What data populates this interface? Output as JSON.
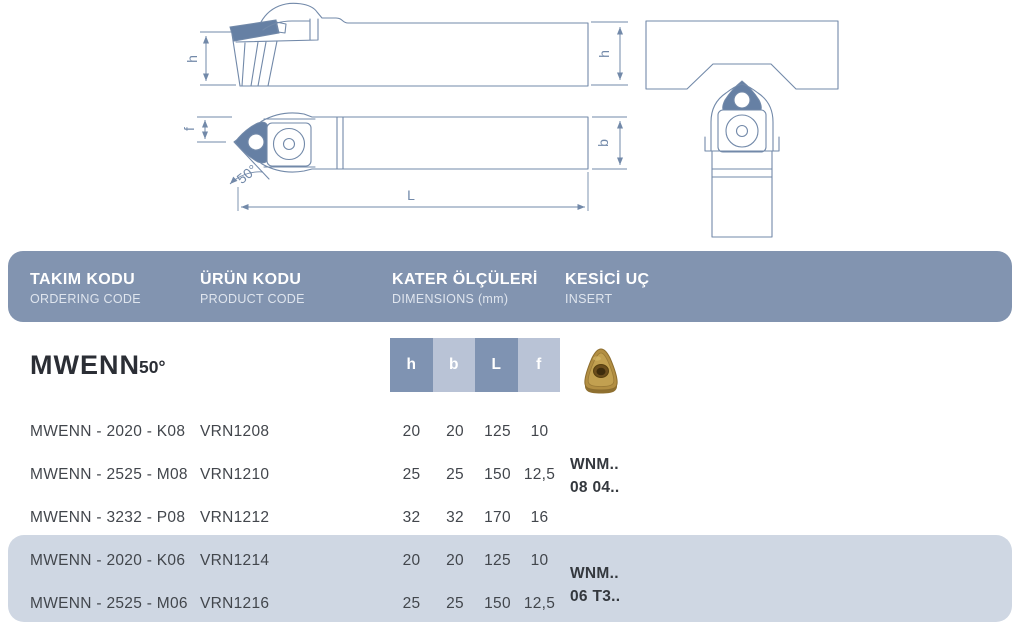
{
  "header": {
    "columns": [
      {
        "title": "TAKIM KODU",
        "subtitle": "ORDERING CODE"
      },
      {
        "title": "ÜRÜN KODU",
        "subtitle": "PRODUCT CODE"
      },
      {
        "title": "KATER ÖLÇÜLERİ",
        "subtitle": "DIMENSIONS (mm)"
      },
      {
        "title": "KESİCİ UÇ",
        "subtitle": "INSERT"
      }
    ]
  },
  "series": {
    "name": "MWENN",
    "approach_angle": "50°",
    "dim_headers": [
      "h",
      "b",
      "L",
      "f"
    ],
    "insert_icon": "wnmg-trigon-gold-insert-icon"
  },
  "rows": [
    {
      "ordering_code": "MWENN - 2020 - K08",
      "product_code": "VRN1208",
      "h": "20",
      "b": "20",
      "L": "125",
      "f": "10",
      "highlighted": false
    },
    {
      "ordering_code": "MWENN - 2525 - M08",
      "product_code": "VRN1210",
      "h": "25",
      "b": "25",
      "L": "150",
      "f": "12,5",
      "highlighted": false
    },
    {
      "ordering_code": "MWENN - 3232 - P08",
      "product_code": "VRN1212",
      "h": "32",
      "b": "32",
      "L": "170",
      "f": "16",
      "highlighted": false
    },
    {
      "ordering_code": "MWENN - 2020 - K06",
      "product_code": "VRN1214",
      "h": "20",
      "b": "20",
      "L": "125",
      "f": "10",
      "highlighted": true
    },
    {
      "ordering_code": "MWENN - 2525 - M06",
      "product_code": "VRN1216",
      "h": "25",
      "b": "25",
      "L": "150",
      "f": "12,5",
      "highlighted": true
    }
  ],
  "insert_groups": [
    {
      "line1": "WNM..",
      "line2": "08 04.."
    },
    {
      "line1": "WNM..",
      "line2": "06 T3.."
    }
  ],
  "drawing_labels": {
    "h_left": "h",
    "h_right": "h",
    "f": "f",
    "angle": "50°",
    "L": "L",
    "b": "b"
  },
  "colors": {
    "header_bar": "#8294b0",
    "dim_cell_dark": "#7f93b2",
    "dim_cell_light": "#b9c3d6",
    "row_highlight": "#cfd7e3",
    "drawing_line": "#7289a9",
    "insert_fill": "#6680a4",
    "insert_gold": "#b28e42",
    "text_dark": "#42464c",
    "header_text": "#ffffff"
  }
}
